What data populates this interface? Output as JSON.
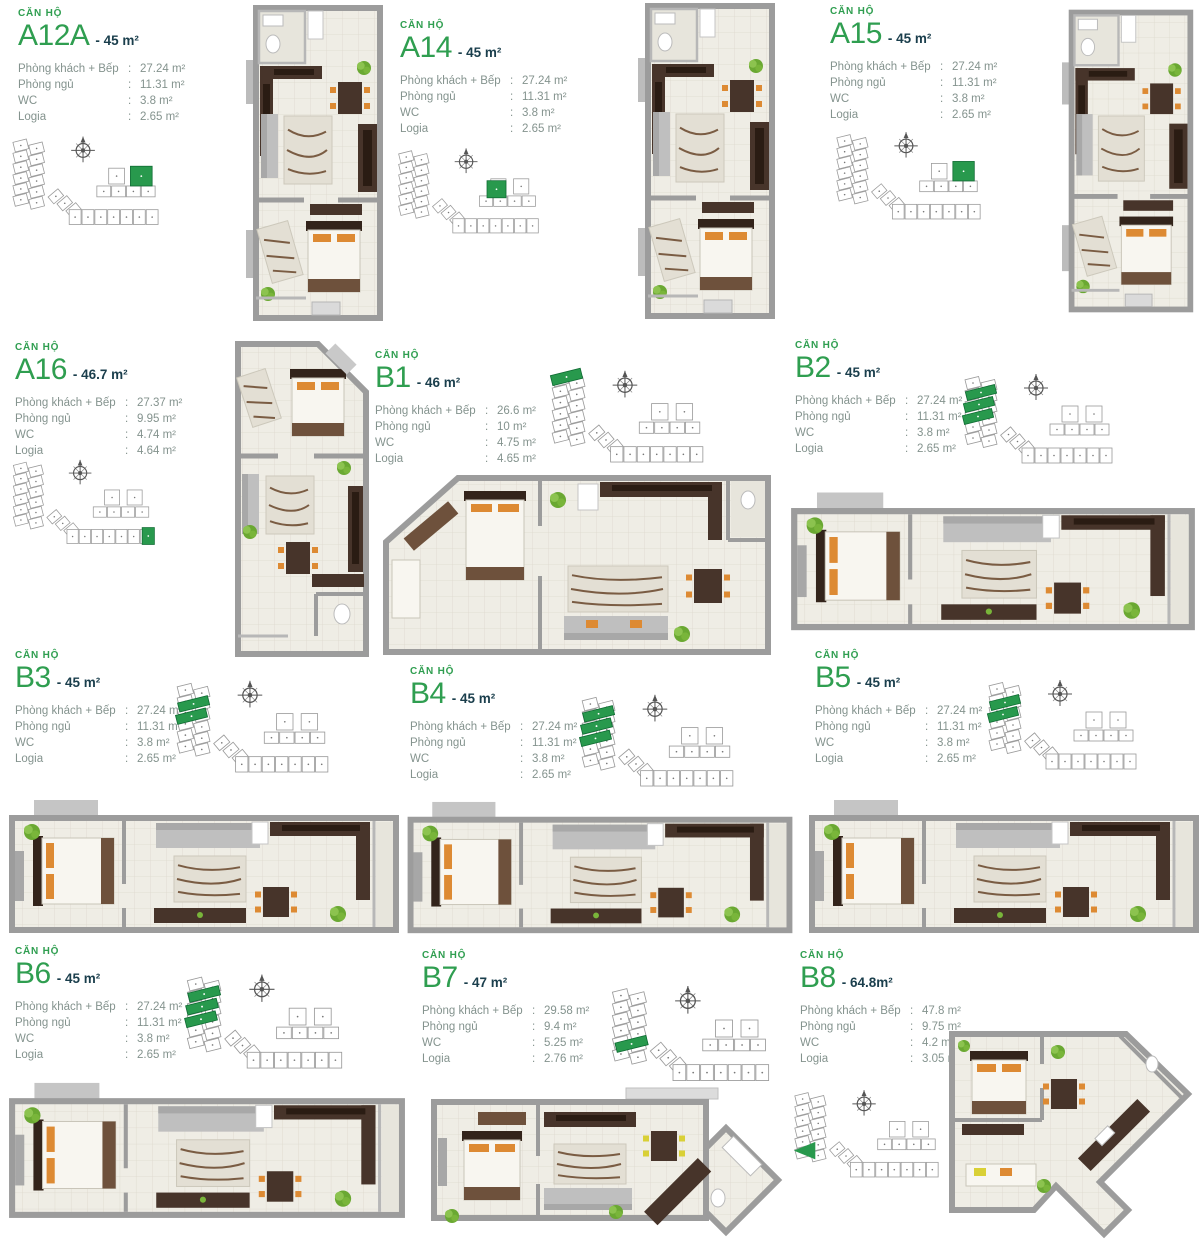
{
  "labels": {
    "unit_prefix": "CĂN HỘ",
    "colon": ":"
  },
  "spec_labels": [
    "Phòng khách + Bếp",
    "Phòng ngủ",
    "WC",
    "Logia"
  ],
  "colors": {
    "green_text": "#2f9e50",
    "area_text": "#1a3e4c",
    "spec_text": "#84938e",
    "highlight_green": "#28994d",
    "wall_gray": "#9c9c9c",
    "floor_beige": "#efede5",
    "furniture_dark": "#47342a",
    "sofa_gray": "#bfbfbf",
    "chair_orange": "#dd8a33",
    "chair_yellow": "#d9d036",
    "plant_green": "#79b53a"
  },
  "units": [
    {
      "id": "a12a",
      "name": "A12A",
      "area": "- 45 m²",
      "specs": [
        "27.24 m²",
        "11.31 m²",
        "3.8 m²",
        "2.65 m²"
      ],
      "plan": "tallA",
      "locator_highlight": "blockA"
    },
    {
      "id": "a14",
      "name": "A14",
      "area": "- 45 m²",
      "specs": [
        "27.24 m²",
        "11.31 m²",
        "3.8 m²",
        "2.65 m²"
      ],
      "plan": "tallA",
      "locator_highlight": "blockA2"
    },
    {
      "id": "a15",
      "name": "A15",
      "area": "- 45 m²",
      "specs": [
        "27.24 m²",
        "11.31 m²",
        "3.8 m²",
        "2.65 m²"
      ],
      "plan": "tallA",
      "locator_highlight": "blockA"
    },
    {
      "id": "a16",
      "name": "A16",
      "area": "- 46.7 m²",
      "specs": [
        "27.37 m²",
        "9.95 m²",
        "4.74 m²",
        "4.64 m²"
      ],
      "plan": "tallChamfer",
      "locator_highlight": "endRight"
    },
    {
      "id": "b1",
      "name": "B1",
      "area": "- 46 m²",
      "specs": [
        "26.6 m²",
        "10 m²",
        "4.75 m²",
        "4.65 m²"
      ],
      "plan": "wideAngled",
      "locator_highlight": "topLeft"
    },
    {
      "id": "b2",
      "name": "B2",
      "area": "- 45 m²",
      "specs": [
        "27.24 m²",
        "11.31 m²",
        "3.8 m²",
        "2.65 m²"
      ],
      "plan": "wide",
      "locator_highlight": "left3"
    },
    {
      "id": "b3",
      "name": "B3",
      "area": "- 45 m²",
      "specs": [
        "27.24 m²",
        "11.31 m²",
        "3.8 m²",
        "2.65 m²"
      ],
      "plan": "wide",
      "locator_highlight": "left2"
    },
    {
      "id": "b4",
      "name": "B4",
      "area": "- 45 m²",
      "specs": [
        "27.24 m²",
        "11.31 m²",
        "3.8 m²",
        "2.65 m²"
      ],
      "plan": "wide",
      "locator_highlight": "left3"
    },
    {
      "id": "b5",
      "name": "B5",
      "area": "- 45 m²",
      "specs": [
        "27.24 m²",
        "11.31 m²",
        "3.8 m²",
        "2.65 m²"
      ],
      "plan": "wide",
      "locator_highlight": "left2"
    },
    {
      "id": "b6",
      "name": "B6",
      "area": "- 45 m²",
      "specs": [
        "27.24 m²",
        "11.31 m²",
        "3.8 m²",
        "2.65 m²"
      ],
      "plan": "wide",
      "locator_highlight": "left3"
    },
    {
      "id": "b7",
      "name": "B7",
      "area": "- 47 m²",
      "specs": [
        "29.58 m²",
        "9.4 m²",
        "5.25 m²",
        "2.76 m²"
      ],
      "plan": "wideDiamond",
      "locator_highlight": "mid1"
    },
    {
      "id": "b8",
      "name": "B8",
      "area": "- 64.8m²",
      "specs": [
        "47.8 m²",
        "9.75 m²",
        "4.2 m²",
        "3.05 m²"
      ],
      "plan": "angular",
      "locator_highlight": "arrow"
    }
  ]
}
